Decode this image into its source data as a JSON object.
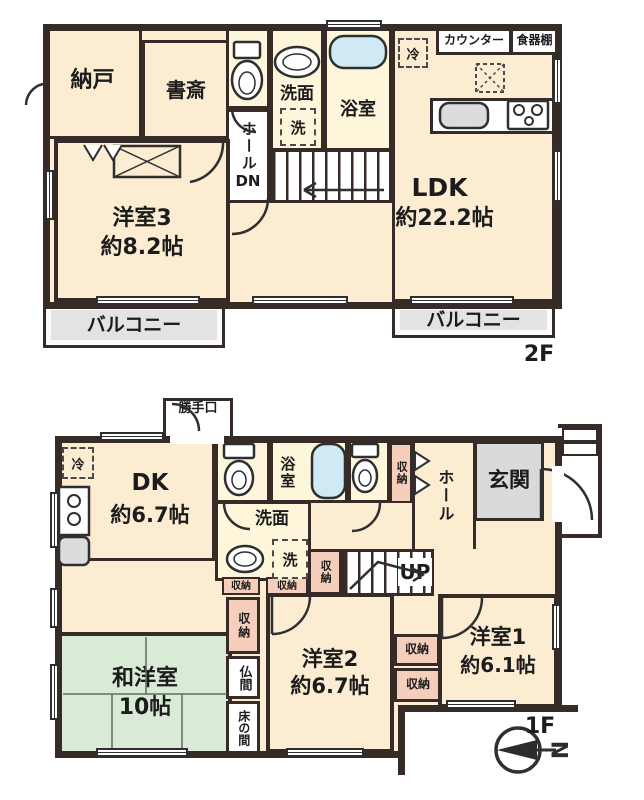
{
  "colors": {
    "wall": "#362b26",
    "room_cream": "#fbecd2",
    "wet_yellow": "#fdf6da",
    "bathtub_blue": "#cfe9f5",
    "storage_pink": "#f6cfbc",
    "tatami_green": "#d9ead7",
    "balcony_gray": "#e3e3e3",
    "genkan_gray": "#dadada"
  },
  "floor2": {
    "floor_label": "2F",
    "nando": "納戸",
    "shosai": "書斎",
    "washroom": "洗面",
    "washer": "洗",
    "bath": "浴室",
    "hall": "ホール",
    "hall_dn": "DN",
    "fridge": "冷",
    "counter": "カウンター",
    "cupboard": "食器棚",
    "ldk_name": "LDK",
    "ldk_size": "約22.2帖",
    "room3_name": "洋室3",
    "room3_size": "約8.2帖",
    "balcony_left": "バルコニー",
    "balcony_right": "バルコニー"
  },
  "floor1": {
    "floor_label": "1F",
    "backdoor": "勝手口",
    "fridge": "冷",
    "dk_name": "DK",
    "dk_size": "約6.7帖",
    "bath": "浴室",
    "washroom": "洗面",
    "washer": "洗",
    "hall": "ホール",
    "genkan": "玄関",
    "stairs_up": "UP",
    "storage_a": "収納",
    "storage_b": "収納",
    "storage_c": "収納",
    "storage_d": "収納",
    "storage_e": "収納",
    "storage_f": "収納",
    "storage_g": "収納",
    "room2_name": "洋室2",
    "room2_size": "約6.7帖",
    "room1_name": "洋室1",
    "room1_size": "約6.1帖",
    "tatami_name": "和洋室",
    "tatami_size": "10帖",
    "butsuma": "仏間",
    "tokonoma": "床の間",
    "compass_north": "N"
  }
}
